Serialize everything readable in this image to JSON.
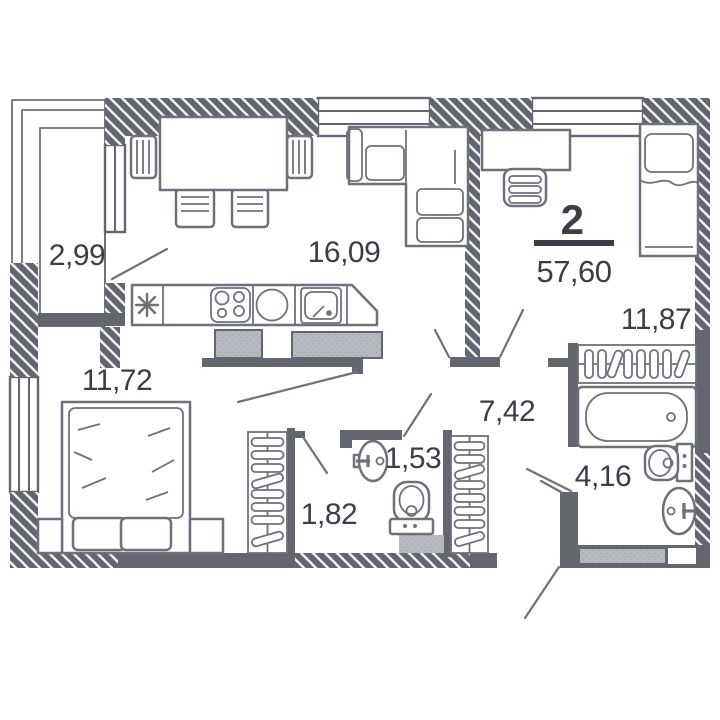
{
  "floorplan": {
    "apartment_summary": {
      "rooms_count": "2",
      "total_area": "57,60"
    },
    "room_areas": {
      "balcony": "2,99",
      "kitchen_living": "16,09",
      "bedroom_right": "11,87",
      "bedroom_left": "11,72",
      "hallway": "7,42",
      "wc": "1,53",
      "closet": "1,82",
      "bathroom": "4,16"
    },
    "colors": {
      "wall": "#63666f",
      "furniture_line": "#6e717b",
      "partition_fill": "#b7b9c0",
      "label_text": "#3b3e47",
      "background": "#ffffff"
    }
  }
}
